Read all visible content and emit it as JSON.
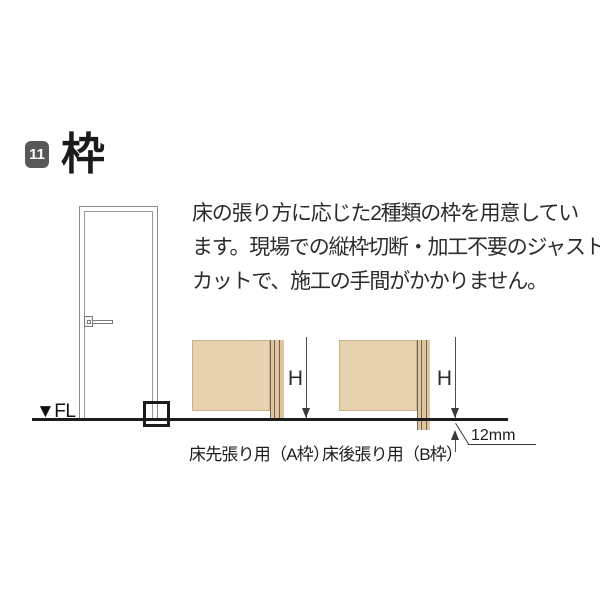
{
  "header": {
    "section_number": "11",
    "title": "枠"
  },
  "description": {
    "lines": [
      "床の張り方に応じた2種類の枠を用意してい",
      "ます。現場での縦枠切断・加工不要のジャスト",
      "カットで、施工の手間がかかりません。"
    ]
  },
  "diagram": {
    "floor_label": "▼FL",
    "frame_a": {
      "label": "床先張り用（A枠）",
      "height_label": "H"
    },
    "frame_b": {
      "label": "床後張り用（B枠）",
      "height_label": "H",
      "offset_label": "12mm"
    },
    "colors": {
      "wall_fill": "#e8d3b0",
      "jamb_fill": "#dfc69e",
      "badge_background": "#595757",
      "floor_line": "#1c1c1c"
    }
  }
}
